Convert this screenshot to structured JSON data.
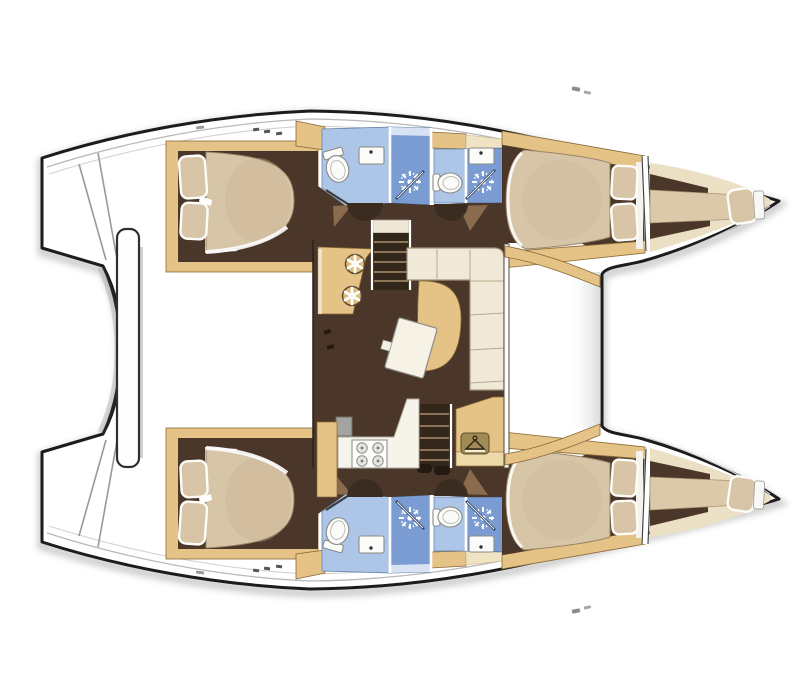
{
  "title": "Catamaran interior layout floor plan (top view, bow right)",
  "vessel": {
    "type": "sailing catamaran",
    "view": "top-down deck and accommodation plan",
    "orientation": "sterns left, bows right",
    "cabin_count": 4,
    "bathroom_count": 4,
    "forepeak_berths": 2
  },
  "hulls": {
    "port": {
      "position": "top",
      "rooms": [
        {
          "name": "aft double cabin",
          "features": [
            "double berth",
            "two pillows",
            "wood trim"
          ]
        },
        {
          "name": "aft bathroom",
          "features": [
            "toilet",
            "sink",
            "shower stall with spray"
          ]
        },
        {
          "name": "forward bathroom",
          "features": [
            "toilet",
            "sink",
            "shower stall with spray"
          ]
        },
        {
          "name": "corridor with doors",
          "features": [
            "door swings"
          ]
        },
        {
          "name": "forward double cabin",
          "features": [
            "double berth",
            "two pillows"
          ]
        },
        {
          "name": "forepeak crew berth",
          "features": [
            "single berth",
            "pillow",
            "bow locker"
          ]
        }
      ]
    },
    "starboard": {
      "position": "bottom",
      "mirrors": "port",
      "rooms": [
        {
          "name": "aft double cabin",
          "features": [
            "double berth",
            "two pillows",
            "wood trim"
          ]
        },
        {
          "name": "aft bathroom",
          "features": [
            "toilet",
            "sink",
            "shower stall with spray"
          ]
        },
        {
          "name": "forward bathroom",
          "features": [
            "toilet",
            "sink",
            "shower stall with spray"
          ]
        },
        {
          "name": "corridor with doors",
          "features": [
            "door swings"
          ]
        },
        {
          "name": "forward double cabin",
          "features": [
            "double berth",
            "two pillows"
          ]
        },
        {
          "name": "forepeak crew berth",
          "features": [
            "single berth",
            "pillow",
            "bow locker"
          ]
        }
      ]
    }
  },
  "saloon": {
    "position": "center bridge deck",
    "features": [
      "forward-facing nav desk with two round stools",
      "companionway stairs to port hull",
      "L-shaped sofa",
      "curved lounge seat",
      "rotated dining table",
      "wardrobe locker with hanger symbol",
      "companionway stairs to starboard hull",
      "galley counter with four-burner stove and fridge"
    ]
  },
  "exterior": {
    "stern": [
      "port transom steps",
      "starboard transom steps",
      "curved aft crossbeam",
      "white davit platform bar"
    ],
    "bow": [
      "forward crossbeam line between bows",
      "two pointed bows"
    ]
  },
  "icons": [
    "shower-spray-icon",
    "toilet-icon",
    "sink-icon",
    "stove-icon",
    "fridge-icon",
    "hanger-icon",
    "stool-icon",
    "stairs",
    "pillow",
    "door-swing"
  ],
  "colors": {
    "outline": "#1c1c1c",
    "shadow": "#a8a8a8",
    "wood": "#e5c285",
    "wood_light": "#efe0b4",
    "wood_dark": "#8a6a38",
    "floor": "#4a3729",
    "floor_light": "#8a6b4e",
    "mattress": "#d7c5a8",
    "mattress_shade": "#c9b190",
    "pillow": "#d8c5a7",
    "linen": "#f5f2ea",
    "sofa": "#f1e9d7",
    "sofa_seam": "#b7aa8e",
    "bath": "#adc6e7",
    "shower": "#7b9cd3",
    "fixture": "#fbfbf9",
    "fixture_stroke": "#8a8a86",
    "table": "#f7f2e6",
    "appliance": "#a3a39f",
    "wand": "#2f3e57",
    "plaque": "#a08b55",
    "tread": "#8d7558",
    "stairwell": "#33271c",
    "doordark": "#3a2c20"
  }
}
